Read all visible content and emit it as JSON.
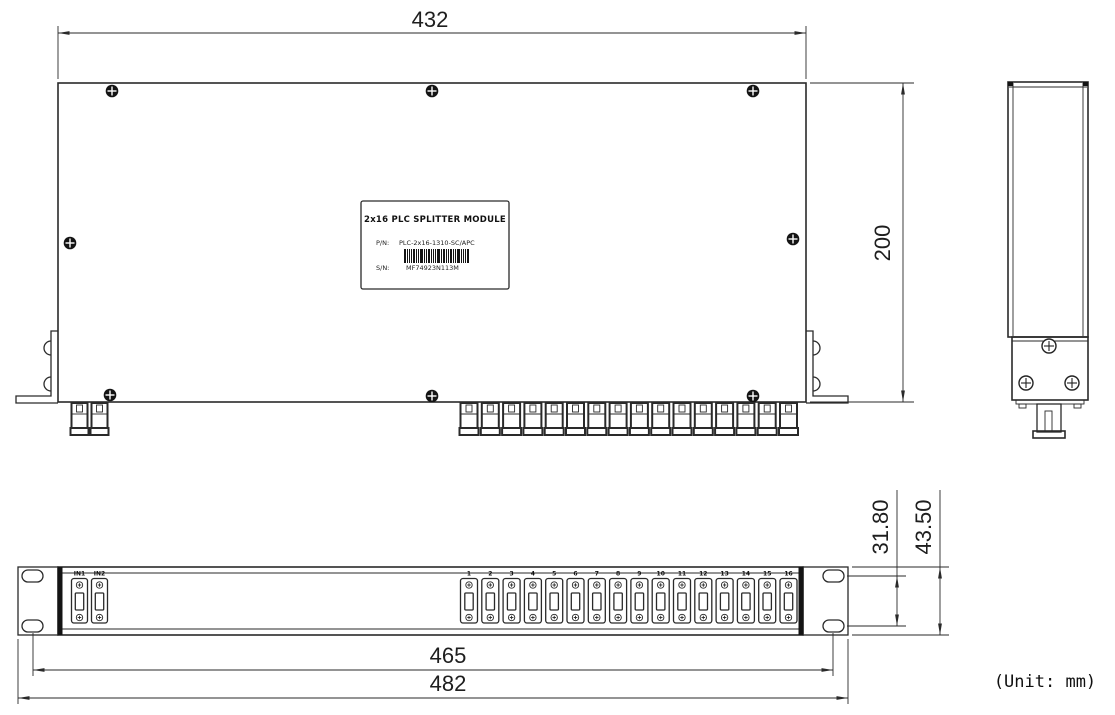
{
  "page": {
    "background": "#ffffff",
    "line_color": "#2a2a2a"
  },
  "unit_note": "(Unit: mm)",
  "dimensions": {
    "top_view_width": "432",
    "top_view_depth": "200",
    "mounting_hole_span": "465",
    "overall_width": "482",
    "ear_hole_spacing": "31.80",
    "panel_height": "43.50"
  },
  "label_plate": {
    "title": "2x16 PLC SPLITTER MODULE",
    "part_number_label": "P/N:",
    "part_number": "PLC-2x16-1310-SC/APC",
    "serial_number_label": "S/N:",
    "serial_number": "MF74923N113M"
  },
  "front_panel": {
    "input_ports": [
      "IN1",
      "IN2"
    ],
    "output_ports": [
      "1",
      "2",
      "3",
      "4",
      "5",
      "6",
      "7",
      "8",
      "9",
      "10",
      "11",
      "12",
      "13",
      "14",
      "15",
      "16"
    ]
  }
}
